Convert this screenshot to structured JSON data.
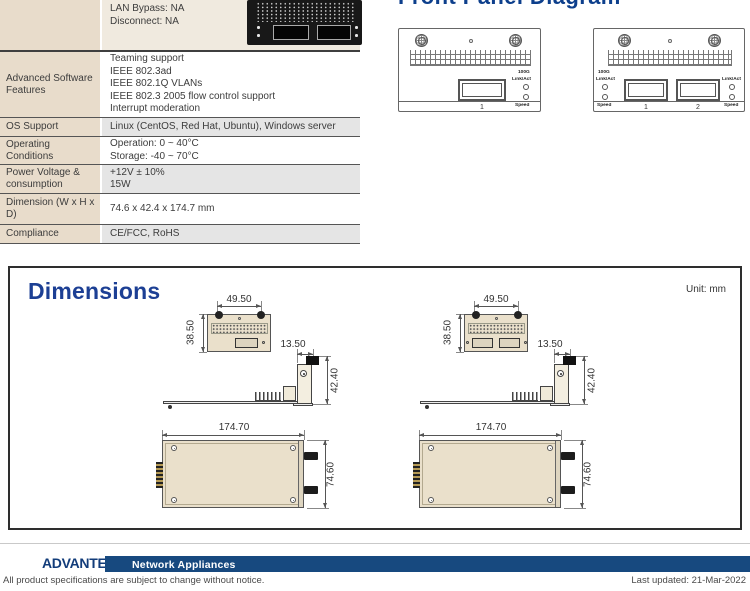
{
  "spec_table": {
    "rows": [
      {
        "label": "",
        "lines": [
          "LAN Bypass: NA",
          "Disconnect: NA"
        ]
      },
      {
        "label": "Advanced Software Features",
        "lines": [
          "Teaming support",
          "IEEE 802.3ad",
          "IEEE 802.1Q VLANs",
          "IEEE 802.3 2005 flow control support",
          "Interrupt moderation"
        ]
      },
      {
        "label": "OS Support",
        "lines": [
          "Linux (CentOS, Red Hat, Ubuntu), Windows server"
        ]
      },
      {
        "label": "Operating Conditions",
        "lines": [
          "Operation: 0 ~ 40°C",
          "Storage: -40 ~ 70°C"
        ]
      },
      {
        "label": "Power Voltage & consumption",
        "lines": [
          "+12V ± 10%",
          "15W"
        ]
      },
      {
        "label": "Dimension (W x H x D)",
        "lines": [
          "74.6 x 42.4 x 174.7 mm"
        ]
      },
      {
        "label": "Compliance",
        "lines": [
          "CE/FCC, RoHS"
        ]
      }
    ]
  },
  "front_panel": {
    "title": "Front Panel Diagram",
    "rate_label": "100G",
    "link_label": "Link/Act",
    "speed_label": "Speed",
    "port1": "1",
    "port2": "2"
  },
  "dimensions": {
    "title": "Dimensions",
    "unit": "Unit: mm",
    "front_width": "49.50",
    "front_height": "38.50",
    "side_width": "13.50",
    "side_height": "42.40",
    "top_length": "174.70",
    "top_width": "74.60"
  },
  "footer": {
    "brand": "ADVANTECH",
    "series": "Network Appliances",
    "notice": "All product specifications are subject to change without notice.",
    "updated": "Last updated: 21-Mar-2022"
  },
  "colors": {
    "heading_navy": "#1c3f94",
    "footer_bar_blue": "#17497f",
    "table_label_beige": "#e8dccb",
    "drawing_beige": "#eae0cb",
    "row_gray": "#e5e5e5"
  }
}
